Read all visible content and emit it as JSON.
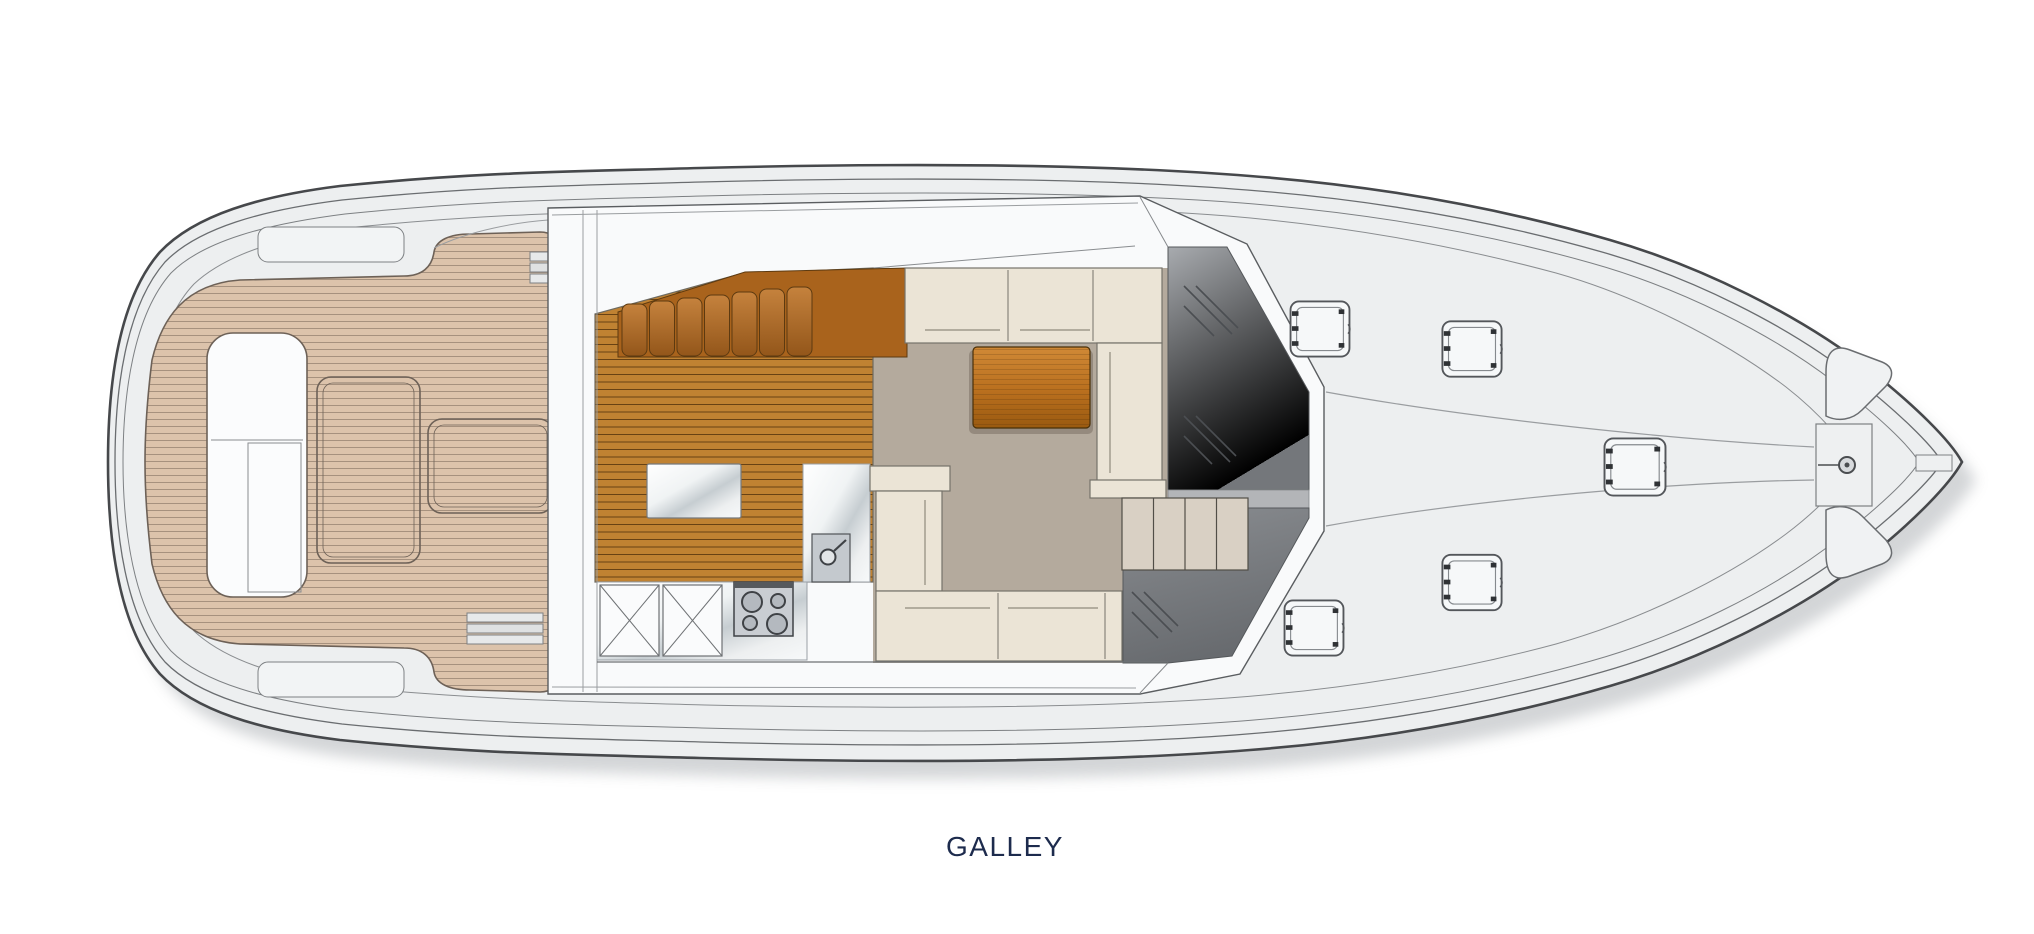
{
  "plan": {
    "label": "GALLEY",
    "type": "yacht-deck-floor-plan",
    "orientation": "bow-right",
    "zones": [
      "aft cockpit teak deck",
      "galley",
      "salon",
      "companionway steps",
      "windshield",
      "foredeck",
      "anchor windlass",
      "bow"
    ],
    "colors": {
      "teak_deck": "#dcc3ab",
      "galley_sole": "#c08232",
      "seat_cushion_wood": "#a9631c",
      "upholstery_cream": "#ebe4d6",
      "carpet_taupe": "#b4aa9d",
      "counter_white": "#f4f6f7",
      "glass_gray": "#84878b",
      "step_beige": "#d9d0c4",
      "hull_line": "#46484b",
      "deck_gray": "#edeff0",
      "label_navy": "#1d2b4d"
    },
    "counts": {
      "bench_cushions": 7,
      "foredeck_hatches": 5,
      "cockpit_teak_hatches": 2,
      "stove_burners": 4,
      "companionway_steps": 4,
      "anchor_lockers": 2
    }
  }
}
